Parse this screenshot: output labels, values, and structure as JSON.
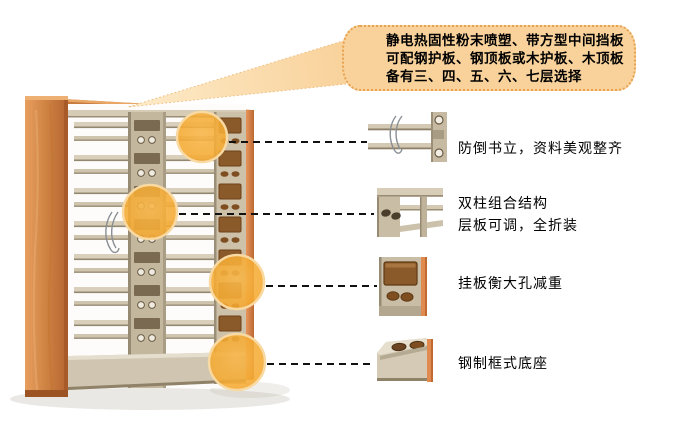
{
  "page": {
    "title": "钢制双柱书架产品细节图",
    "type": "product-annotation-diagram"
  },
  "callout": {
    "lines": [
      "静电热固性粉末喷塑、带方型中间挡板",
      "可配钢护板、钢顶板或木护板、木顶板",
      "备有三、四、五、六、七层选择"
    ]
  },
  "annotations": [
    {
      "id": 1,
      "thumbnail_icon": "book-support-detail",
      "label_lines": [
        "防倒书立，资料美观整齐"
      ]
    },
    {
      "id": 2,
      "thumbnail_icon": "double-column-structure-detail",
      "label_lines": [
        "双柱组合结构",
        "层板可调，全折装"
      ]
    },
    {
      "id": 3,
      "thumbnail_icon": "hanging-plate-holes-detail",
      "label_lines": [
        "挂板衡大孔减重"
      ]
    },
    {
      "id": 4,
      "thumbnail_icon": "steel-frame-base-detail",
      "label_lines": [
        "钢制框式底座"
      ]
    }
  ],
  "palette": {
    "bubble_fill": "#F9D29B",
    "bubble_border": "#E7A24F",
    "highlight_circle": "#F5AB33",
    "highlight_rim": "#F9D9A2",
    "wood": "#D08544",
    "wood_dark": "#B06030",
    "metal_light": "#D9CFBA",
    "metal_mid": "#C6BAA2",
    "hole_brown": "#8B5A2B",
    "connector": "#111111"
  }
}
